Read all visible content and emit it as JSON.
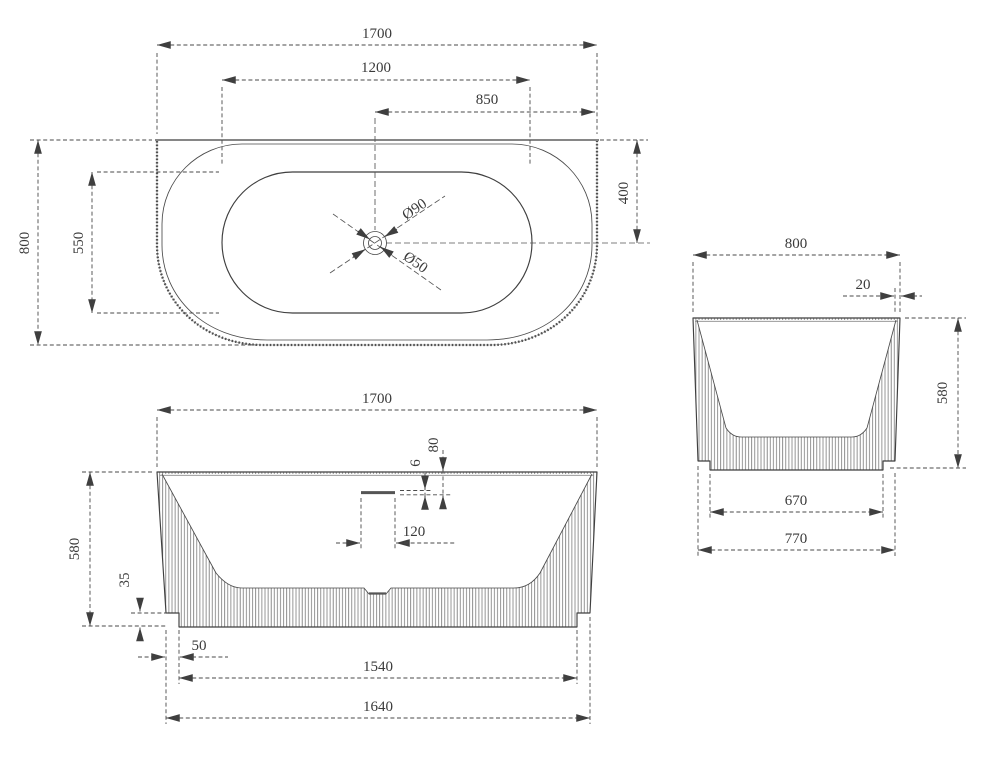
{
  "drawing": {
    "type": "bathtub-three-view-technical-drawing",
    "background": "#ffffff",
    "line_color": "#3f3f3f",
    "dim_color": "#4a4a4a"
  },
  "dims": {
    "top": {
      "length": "1700",
      "inner_length": "1200",
      "drain_offset_x": "850",
      "width": "800",
      "inner_width": "550",
      "drain_offset_y": "400",
      "drain_outer_dia": "Ø90",
      "drain_waste_dia": "Ø50"
    },
    "front": {
      "length": "1700",
      "overflow_slot_height": "6",
      "overflow_below_rim": "80",
      "overflow_width": "120",
      "height": "580",
      "plinth_height": "35",
      "base_inset": "50",
      "base_length": "1540",
      "bottom_length": "1640"
    },
    "side": {
      "width": "800",
      "rim_thickness": "20",
      "height": "580",
      "base_width": "670",
      "bottom_width": "770"
    }
  }
}
